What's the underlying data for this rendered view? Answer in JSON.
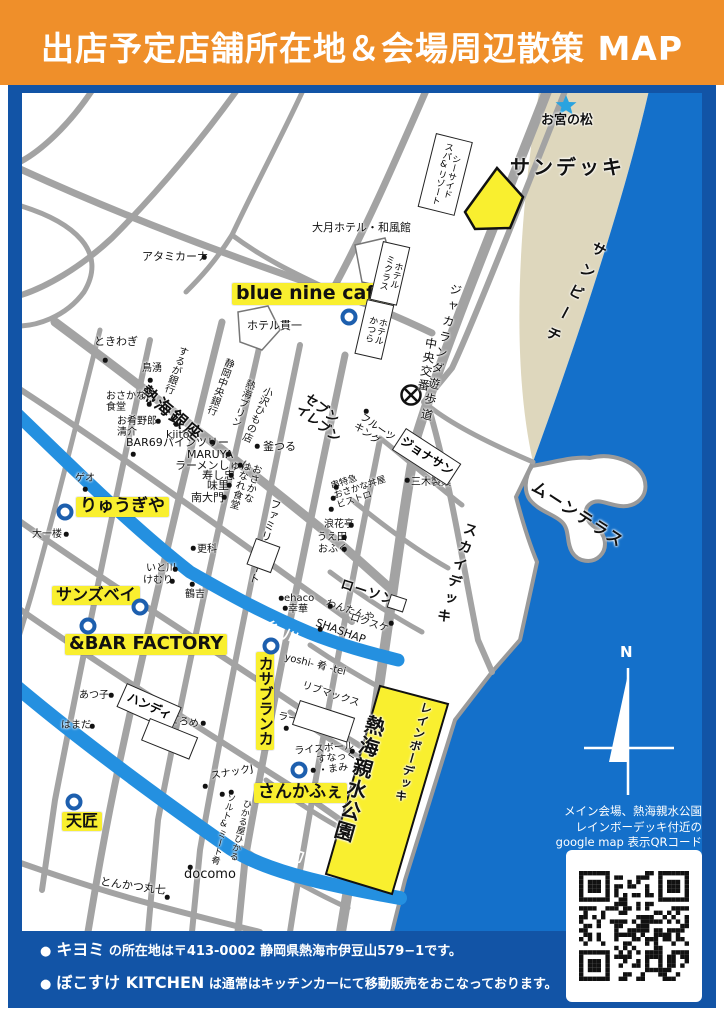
{
  "header": {
    "title": "出店予定店舗所在地＆会場周辺散策 MAP"
  },
  "colors": {
    "header_bg": "#ef8f2a",
    "frame": "#1254a6",
    "sea": "#1470ca",
    "beach": "#ded7bd",
    "river": "#2490e0",
    "road": "#a3a3a3",
    "hl": "#f9ef2f",
    "ring": "#1d5fae"
  },
  "map": {
    "highlight_labels": [
      {
        "id": "blue-nine-cafe",
        "t": "blue nine cafe",
        "x": 232,
        "y": 283,
        "fs": 19
      },
      {
        "id": "ryugiya",
        "t": "りゅうぎや",
        "x": 76,
        "y": 497,
        "fs": 17
      },
      {
        "id": "sunsbay",
        "t": "サンズベイ",
        "x": 52,
        "y": 586,
        "fs": 16
      },
      {
        "id": "bar-factory",
        "t": "&BAR FACTORY",
        "x": 65,
        "y": 634,
        "fs": 18
      },
      {
        "id": "casablanca",
        "t": "カサブランカ",
        "x": 256,
        "y": 652,
        "fs": 15,
        "v": 1
      },
      {
        "id": "sankafe",
        "t": "さんかふぇ",
        "x": 254,
        "y": 783,
        "fs": 17
      },
      {
        "id": "tensho",
        "t": "天匠",
        "x": 62,
        "y": 812,
        "fs": 16
      }
    ],
    "labels": [
      {
        "id": "omiya-no-matsu",
        "t": "お宮の松",
        "x": 541,
        "y": 114,
        "fs": 13,
        "b": 1
      },
      {
        "id": "sun-deck",
        "t": "サンデッキ",
        "x": 510,
        "y": 156,
        "fs": 20,
        "b": 1,
        "ls": 3
      },
      {
        "id": "sun-beach",
        "t": "サンビーチ",
        "x": 594,
        "y": 238,
        "fs": 15,
        "b": 1,
        "v": 1,
        "rot": 28,
        "ls": 9
      },
      {
        "id": "jacaranda-promenade",
        "t": "ジャカランダ遊歩道",
        "x": 449,
        "y": 282,
        "fs": 12,
        "v": 1,
        "rot": 13,
        "ls": 4
      },
      {
        "id": "chuo-koban",
        "t": "中央交番",
        "x": 424,
        "y": 336,
        "fs": 12,
        "v": 1,
        "rot": 10,
        "ls": 2
      },
      {
        "id": "otsuki-hotel",
        "t": "大月ホテル・和風館",
        "x": 312,
        "y": 222,
        "fs": 11
      },
      {
        "id": "atamikana",
        "t": "アタミカーナ",
        "x": 142,
        "y": 251,
        "fs": 11
      },
      {
        "id": "hotel-kanichi",
        "t": "ホテル貫一",
        "x": 247,
        "y": 320,
        "fs": 11
      },
      {
        "id": "tokiwagi",
        "t": "ときわぎ",
        "x": 94,
        "y": 336,
        "fs": 11
      },
      {
        "id": "toriwaki",
        "t": "鳥湧",
        "x": 142,
        "y": 363,
        "fs": 10
      },
      {
        "id": "suruga-bank",
        "t": "するが銀行",
        "x": 178,
        "y": 344,
        "fs": 10,
        "v": 1,
        "rot": 20
      },
      {
        "id": "atami-ginza",
        "t": "熱海銀座",
        "x": 148,
        "y": 383,
        "fs": 17,
        "b": 1,
        "rot": 40,
        "ls": 2
      },
      {
        "id": "osakana-shokudo",
        "t": "おさかな\n食堂",
        "x": 106,
        "y": 391,
        "fs": 10
      },
      {
        "id": "osakana-yaro-seisuke",
        "t": "お肴野郎\n清介",
        "x": 117,
        "y": 416,
        "fs": 10
      },
      {
        "id": "kiito",
        "t": "kiito",
        "x": 166,
        "y": 429,
        "fs": 11
      },
      {
        "id": "shizuoka-chuo-bank",
        "t": "静岡中央銀行",
        "x": 224,
        "y": 356,
        "fs": 10,
        "v": 1,
        "rot": 20
      },
      {
        "id": "atami-pudding",
        "t": "熱海プリン",
        "x": 245,
        "y": 377,
        "fs": 10,
        "v": 1,
        "rot": 20
      },
      {
        "id": "ozawa-himono",
        "t": "小沢ひもの店",
        "x": 263,
        "y": 384,
        "fs": 10,
        "v": 1,
        "rot": 24
      },
      {
        "id": "bar69",
        "t": "BAR69",
        "x": 126,
        "y": 437,
        "fs": 11
      },
      {
        "id": "pine-tree",
        "t": "パインツリー",
        "x": 163,
        "y": 437,
        "fs": 11
      },
      {
        "id": "maruya",
        "t": "MARUYA",
        "x": 187,
        "y": 449,
        "fs": 11
      },
      {
        "id": "ramen-shun",
        "t": "ラーメンしゅん",
        "x": 175,
        "y": 460,
        "fs": 11
      },
      {
        "id": "sushichu",
        "t": "寿し忠",
        "x": 202,
        "y": 470,
        "fs": 11
      },
      {
        "id": "ajisato",
        "t": "味里",
        "x": 207,
        "y": 480,
        "fs": 11
      },
      {
        "id": "nandaimon",
        "t": "南大門",
        "x": 191,
        "y": 492,
        "fs": 11
      },
      {
        "id": "kamatsuru",
        "t": "釜つる",
        "x": 263,
        "y": 441,
        "fs": 11
      },
      {
        "id": "osakana-hanare",
        "t": "おさかな\nはなれ食堂",
        "x": 240,
        "y": 459,
        "fs": 10,
        "v": 1,
        "rot": 16
      },
      {
        "id": "family-mart",
        "t": "ファミリーマート",
        "x": 270,
        "y": 497,
        "fs": 11,
        "v": 1,
        "rot": 16
      },
      {
        "id": "seven-eleven",
        "t": "セブン\nイレブン",
        "x": 310,
        "y": 392,
        "fs": 13,
        "b": 1,
        "rot": 38
      },
      {
        "id": "fruits-king",
        "t": "フルーツ\nキング",
        "x": 364,
        "y": 412,
        "fs": 10,
        "rot": 35
      },
      {
        "id": "mikiseika",
        "t": "三木製菓",
        "x": 411,
        "y": 477,
        "fs": 10
      },
      {
        "id": "kushi-tokkyu-bistro",
        "t": "串特急\nおさかな丼屋\nビストロ",
        "x": 330,
        "y": 483,
        "fs": 9,
        "rot": -18
      },
      {
        "id": "naniwatei",
        "t": "浪花亭",
        "x": 324,
        "y": 519,
        "fs": 10
      },
      {
        "id": "ueda",
        "t": "うえ田",
        "x": 317,
        "y": 532,
        "fs": 10
      },
      {
        "id": "ofuku",
        "t": "おふく",
        "x": 318,
        "y": 544,
        "fs": 10
      },
      {
        "id": "moon-terrace",
        "t": "ムーンテラス",
        "x": 538,
        "y": 478,
        "fs": 16,
        "b": 1,
        "rot": 33,
        "ls": 2
      },
      {
        "id": "sky-deck",
        "t": "スカイデッキ",
        "x": 464,
        "y": 520,
        "fs": 14,
        "b": 1,
        "v": 1,
        "rot": 17,
        "ls": 4
      },
      {
        "id": "lawson",
        "t": "ローソン",
        "x": 343,
        "y": 578,
        "fs": 13,
        "b": 1,
        "rot": 18,
        "ls": 1
      },
      {
        "id": "wantanya",
        "t": "わんたんや",
        "x": 328,
        "y": 598,
        "fs": 10,
        "rot": 18
      },
      {
        "id": "rokusuke",
        "t": "ロクスケ",
        "x": 352,
        "y": 612,
        "fs": 10,
        "rot": 18
      },
      {
        "id": "shashap",
        "t": "SHASHAP",
        "x": 318,
        "y": 617,
        "fs": 11,
        "rot": 20
      },
      {
        "id": "ehaco",
        "t": "ehaco",
        "x": 284,
        "y": 593,
        "fs": 10
      },
      {
        "id": "kouka",
        "t": "幸華",
        "x": 288,
        "y": 604,
        "fs": 10
      },
      {
        "id": "itogawa-river-name",
        "t": "糸川",
        "x": 268,
        "y": 619,
        "fs": 14,
        "b": 1,
        "rot": 25,
        "c": "#ffffff",
        "ls": 7
      },
      {
        "id": "yoshi-sakana-tei",
        "t": "yoshi- 肴 -tei",
        "x": 286,
        "y": 652,
        "fs": 10,
        "rot": 14
      },
      {
        "id": "livemax",
        "t": "リブマックス",
        "x": 304,
        "y": 680,
        "fs": 10,
        "rot": 18
      },
      {
        "id": "ramen-ittetsu",
        "t": "ラーメン一徹",
        "x": 279,
        "y": 711,
        "fs": 10,
        "rot": 10
      },
      {
        "id": "riceball",
        "t": "ライスボール",
        "x": 294,
        "y": 746,
        "fs": 10,
        "rot": -5
      },
      {
        "id": "snack-mami",
        "t": "すなっく\n・まみ",
        "x": 316,
        "y": 755,
        "fs": 10,
        "rot": -8
      },
      {
        "id": "snack-j",
        "t": "スナックJ",
        "x": 210,
        "y": 771,
        "fs": 10,
        "rot": -10
      },
      {
        "id": "salt-and-meat",
        "t": "ソルト&ミート肴",
        "x": 226,
        "y": 792,
        "fs": 9,
        "v": 1,
        "rot": 14
      },
      {
        "id": "hikaruya-hikaru",
        "t": "ひかる屋ひかる",
        "x": 242,
        "y": 798,
        "fs": 9,
        "v": 1,
        "rot": 14
      },
      {
        "id": "docomo",
        "t": "docomo",
        "x": 184,
        "y": 868,
        "fs": 13
      },
      {
        "id": "tonkatsu-marushichi",
        "t": "とんかつ丸七",
        "x": 101,
        "y": 876,
        "fs": 11,
        "rot": 8
      },
      {
        "id": "hamada",
        "t": "はまだ",
        "x": 61,
        "y": 720,
        "fs": 10
      },
      {
        "id": "atsuko",
        "t": "あつ子",
        "x": 79,
        "y": 690,
        "fs": 10
      },
      {
        "id": "dorome",
        "t": "どろめ",
        "x": 170,
        "y": 714,
        "fs": 10,
        "rot": 10
      },
      {
        "id": "sarashina",
        "t": "更科",
        "x": 197,
        "y": 544,
        "fs": 10
      },
      {
        "id": "itokawa-restaurant",
        "t": "いと川",
        "x": 146,
        "y": 563,
        "fs": 10
      },
      {
        "id": "kemuri",
        "t": "けむり",
        "x": 143,
        "y": 575,
        "fs": 10
      },
      {
        "id": "tsuruyoshi",
        "t": "鶴吉",
        "x": 185,
        "y": 589,
        "fs": 10
      },
      {
        "id": "geo",
        "t": "ゲオ",
        "x": 75,
        "y": 473,
        "fs": 10
      },
      {
        "id": "daiichiro",
        "t": "大一楼",
        "x": 32,
        "y": 529,
        "fs": 10
      },
      {
        "id": "hatsukawa-river-name",
        "t": "初川",
        "x": 292,
        "y": 848,
        "fs": 14,
        "b": 1,
        "rot": 18,
        "c": "#ffffff",
        "ls": 7
      },
      {
        "id": "atami-shinsui-park",
        "t": "熱海親水公園",
        "x": 365,
        "y": 712,
        "fs": 20,
        "b": 1,
        "v": 1,
        "rot": 16,
        "ls": 2
      },
      {
        "id": "rainbow-deck",
        "t": "レインボーデッキ",
        "x": 420,
        "y": 700,
        "fs": 12,
        "b": 1,
        "v": 1,
        "rot": 16,
        "ls": 1
      },
      {
        "id": "compass-north",
        "t": "N",
        "x": 620,
        "y": 644,
        "fs": 15,
        "b": 1,
        "c": "#ffffff"
      }
    ],
    "boxed_labels": [
      {
        "id": "seaside-spa-resort",
        "t": "シーサイド\nスパ&リゾート",
        "x": 436,
        "y": 133,
        "w": 36,
        "h": 74,
        "rot": 14,
        "fs": 9,
        "v": 1
      },
      {
        "id": "hotel-micuras",
        "t": "ホテル\nミクラス",
        "x": 383,
        "y": 241,
        "w": 26,
        "h": 58,
        "rot": 13,
        "fs": 9,
        "v": 1
      },
      {
        "id": "hotel-katsura",
        "t": "ホテル\nかつら",
        "x": 367,
        "y": 299,
        "w": 26,
        "h": 54,
        "rot": 13,
        "fs": 9,
        "v": 1
      },
      {
        "id": "jonathan",
        "t": "ジョナサン",
        "x": 406,
        "y": 428,
        "w": 64,
        "h": 24,
        "rot": 33,
        "fs": 12,
        "b": 1
      },
      {
        "id": "handy",
        "t": "ハンディ",
        "x": 127,
        "y": 683,
        "w": 58,
        "h": 24,
        "rot": 24,
        "fs": 12,
        "b": 1
      },
      {
        "id": "livemax-building",
        "t": "",
        "x": 300,
        "y": 700,
        "w": 56,
        "h": 24,
        "rot": 18
      },
      {
        "id": "lawson-building",
        "t": "",
        "x": 391,
        "y": 594,
        "w": 15,
        "h": 12,
        "rot": 18
      },
      {
        "id": "building-near-sarashina",
        "t": "",
        "x": 256,
        "y": 538,
        "w": 24,
        "h": 26,
        "rot": 20
      },
      {
        "id": "building-near-dorome",
        "t": "",
        "x": 150,
        "y": 718,
        "w": 50,
        "h": 22,
        "rot": 22
      }
    ],
    "markers": [
      {
        "id": "marker-blue-nine-cafe",
        "x": 349,
        "y": 317
      },
      {
        "id": "marker-ryugiya",
        "x": 65,
        "y": 512
      },
      {
        "id": "marker-sunsbay",
        "x": 140,
        "y": 607
      },
      {
        "id": "marker-bar-factory",
        "x": 88,
        "y": 626
      },
      {
        "id": "marker-casablanca",
        "x": 271,
        "y": 646
      },
      {
        "id": "marker-sankafe",
        "x": 299,
        "y": 770
      },
      {
        "id": "marker-tensho",
        "x": 74,
        "y": 802
      }
    ],
    "dots": [
      [
        204,
        257
      ],
      [
        105,
        360
      ],
      [
        150,
        380
      ],
      [
        149,
        404
      ],
      [
        158,
        421
      ],
      [
        176,
        424
      ],
      [
        133,
        454
      ],
      [
        212,
        442
      ],
      [
        228,
        454
      ],
      [
        240,
        465
      ],
      [
        231,
        475
      ],
      [
        229,
        485
      ],
      [
        224,
        497
      ],
      [
        257,
        446
      ],
      [
        407,
        480
      ],
      [
        336,
        487
      ],
      [
        333,
        498
      ],
      [
        331,
        509
      ],
      [
        351,
        525
      ],
      [
        344,
        537
      ],
      [
        344,
        549
      ],
      [
        366,
        411
      ],
      [
        330,
        606
      ],
      [
        391,
        623
      ],
      [
        320,
        629
      ],
      [
        281,
        598
      ],
      [
        285,
        608
      ],
      [
        286,
        728
      ],
      [
        352,
        751
      ],
      [
        313,
        770
      ],
      [
        205,
        786
      ],
      [
        222,
        794
      ],
      [
        231,
        792
      ],
      [
        190,
        867
      ],
      [
        167,
        897
      ],
      [
        92,
        726
      ],
      [
        111,
        695
      ],
      [
        203,
        723
      ],
      [
        193,
        548
      ],
      [
        175,
        569
      ],
      [
        172,
        581
      ],
      [
        192,
        584
      ],
      [
        85,
        489
      ],
      [
        66,
        534
      ]
    ],
    "qr_note_lines": [
      "メイン会場、熱海親水公園",
      "レインボーデッキ付近の",
      "google map 表示QRコード"
    ]
  },
  "footer": {
    "bullet": "●",
    "lines": [
      {
        "name": "キヨミ",
        "rest": " の所在地は〒413-0002 静岡県熱海市伊豆山579−1です。"
      },
      {
        "name": "ぼこすけ KITCHEN",
        "rest": " は通常はキッチンカーにて移動販売をおこなっております。"
      }
    ]
  }
}
